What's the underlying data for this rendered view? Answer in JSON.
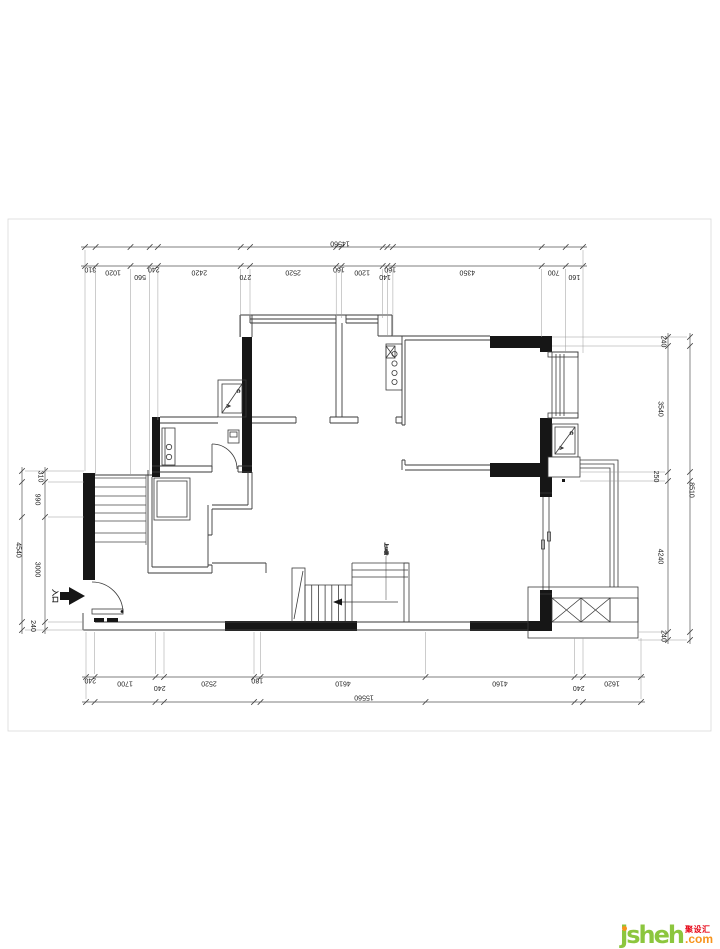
{
  "drawing": {
    "type": "residential floor plan",
    "dims": {
      "top": {
        "total": "14560",
        "segments": [
          "310",
          "1020",
          "560",
          "240",
          "2420",
          "270",
          "2520",
          "160",
          "1200",
          "140",
          "160",
          "4350",
          "700",
          "160"
        ]
      },
      "bottom": {
        "total": "15560",
        "segments": [
          "240",
          "1700",
          "240",
          "2520",
          "180",
          "4610",
          "4160",
          "240",
          "1620"
        ]
      },
      "left": {
        "total": "4540",
        "segments": [
          "310",
          "990",
          "3000",
          "240"
        ]
      },
      "right": {
        "total": "8510",
        "segments": [
          "240",
          "3540",
          "250",
          "4240",
          "240"
        ]
      }
    },
    "labels": {
      "entrance": "入口",
      "stair_note": "上18阶",
      "ac": [
        "A",
        "C"
      ]
    }
  },
  "logo": {
    "brand": "jsheh",
    "cn": "聚设汇",
    "tld": ".com"
  },
  "colors": {
    "wall_fill": "#161616",
    "line": "#3A3A3A",
    "dim_line": "#555555",
    "logo_green": "#8CC63E",
    "logo_orange": "#F7941D",
    "logo_red": "#E60012"
  }
}
